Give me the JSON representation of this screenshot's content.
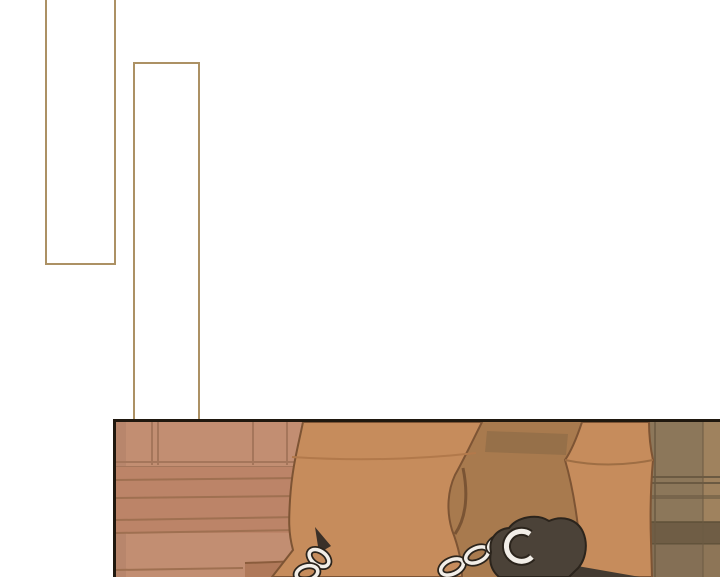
{
  "page": {
    "background_color": "#ffffff",
    "type_label": "comic-page"
  },
  "bubbles": {
    "border_color": "#ac9164",
    "overlap_border_color": "#3c2d1d",
    "items": [
      {
        "id": "bubble-1",
        "text": ""
      },
      {
        "id": "bubble-2",
        "text": ""
      }
    ]
  },
  "panel": {
    "border_color": "#1f180f",
    "colors": {
      "wall": "#c28e72",
      "wall_line": "#a5765b",
      "boards": "#bc8468",
      "board_line": "#9f7051",
      "step": "#b0795a",
      "step_edge": "#8a5c3c",
      "leg": "#c68c5c",
      "leg_outline": "#7d5434",
      "leg_seam": "#b2794b",
      "leg2_seam": "#9e6e44",
      "shadow_gap": "#a87a4e",
      "patch": "#967049",
      "pillar": "#8c775a",
      "pillar_dark": "#6b5a42",
      "pillar_band": "#6f5d45",
      "pillar_light": "#a58560",
      "floor_wedge": "#b3845a",
      "chain_light": "#f2eee8",
      "chain_dark": "#2b241c",
      "shackle": "#4b4238",
      "shackle_tail": "#433a30",
      "strap": "#7a5434"
    }
  }
}
